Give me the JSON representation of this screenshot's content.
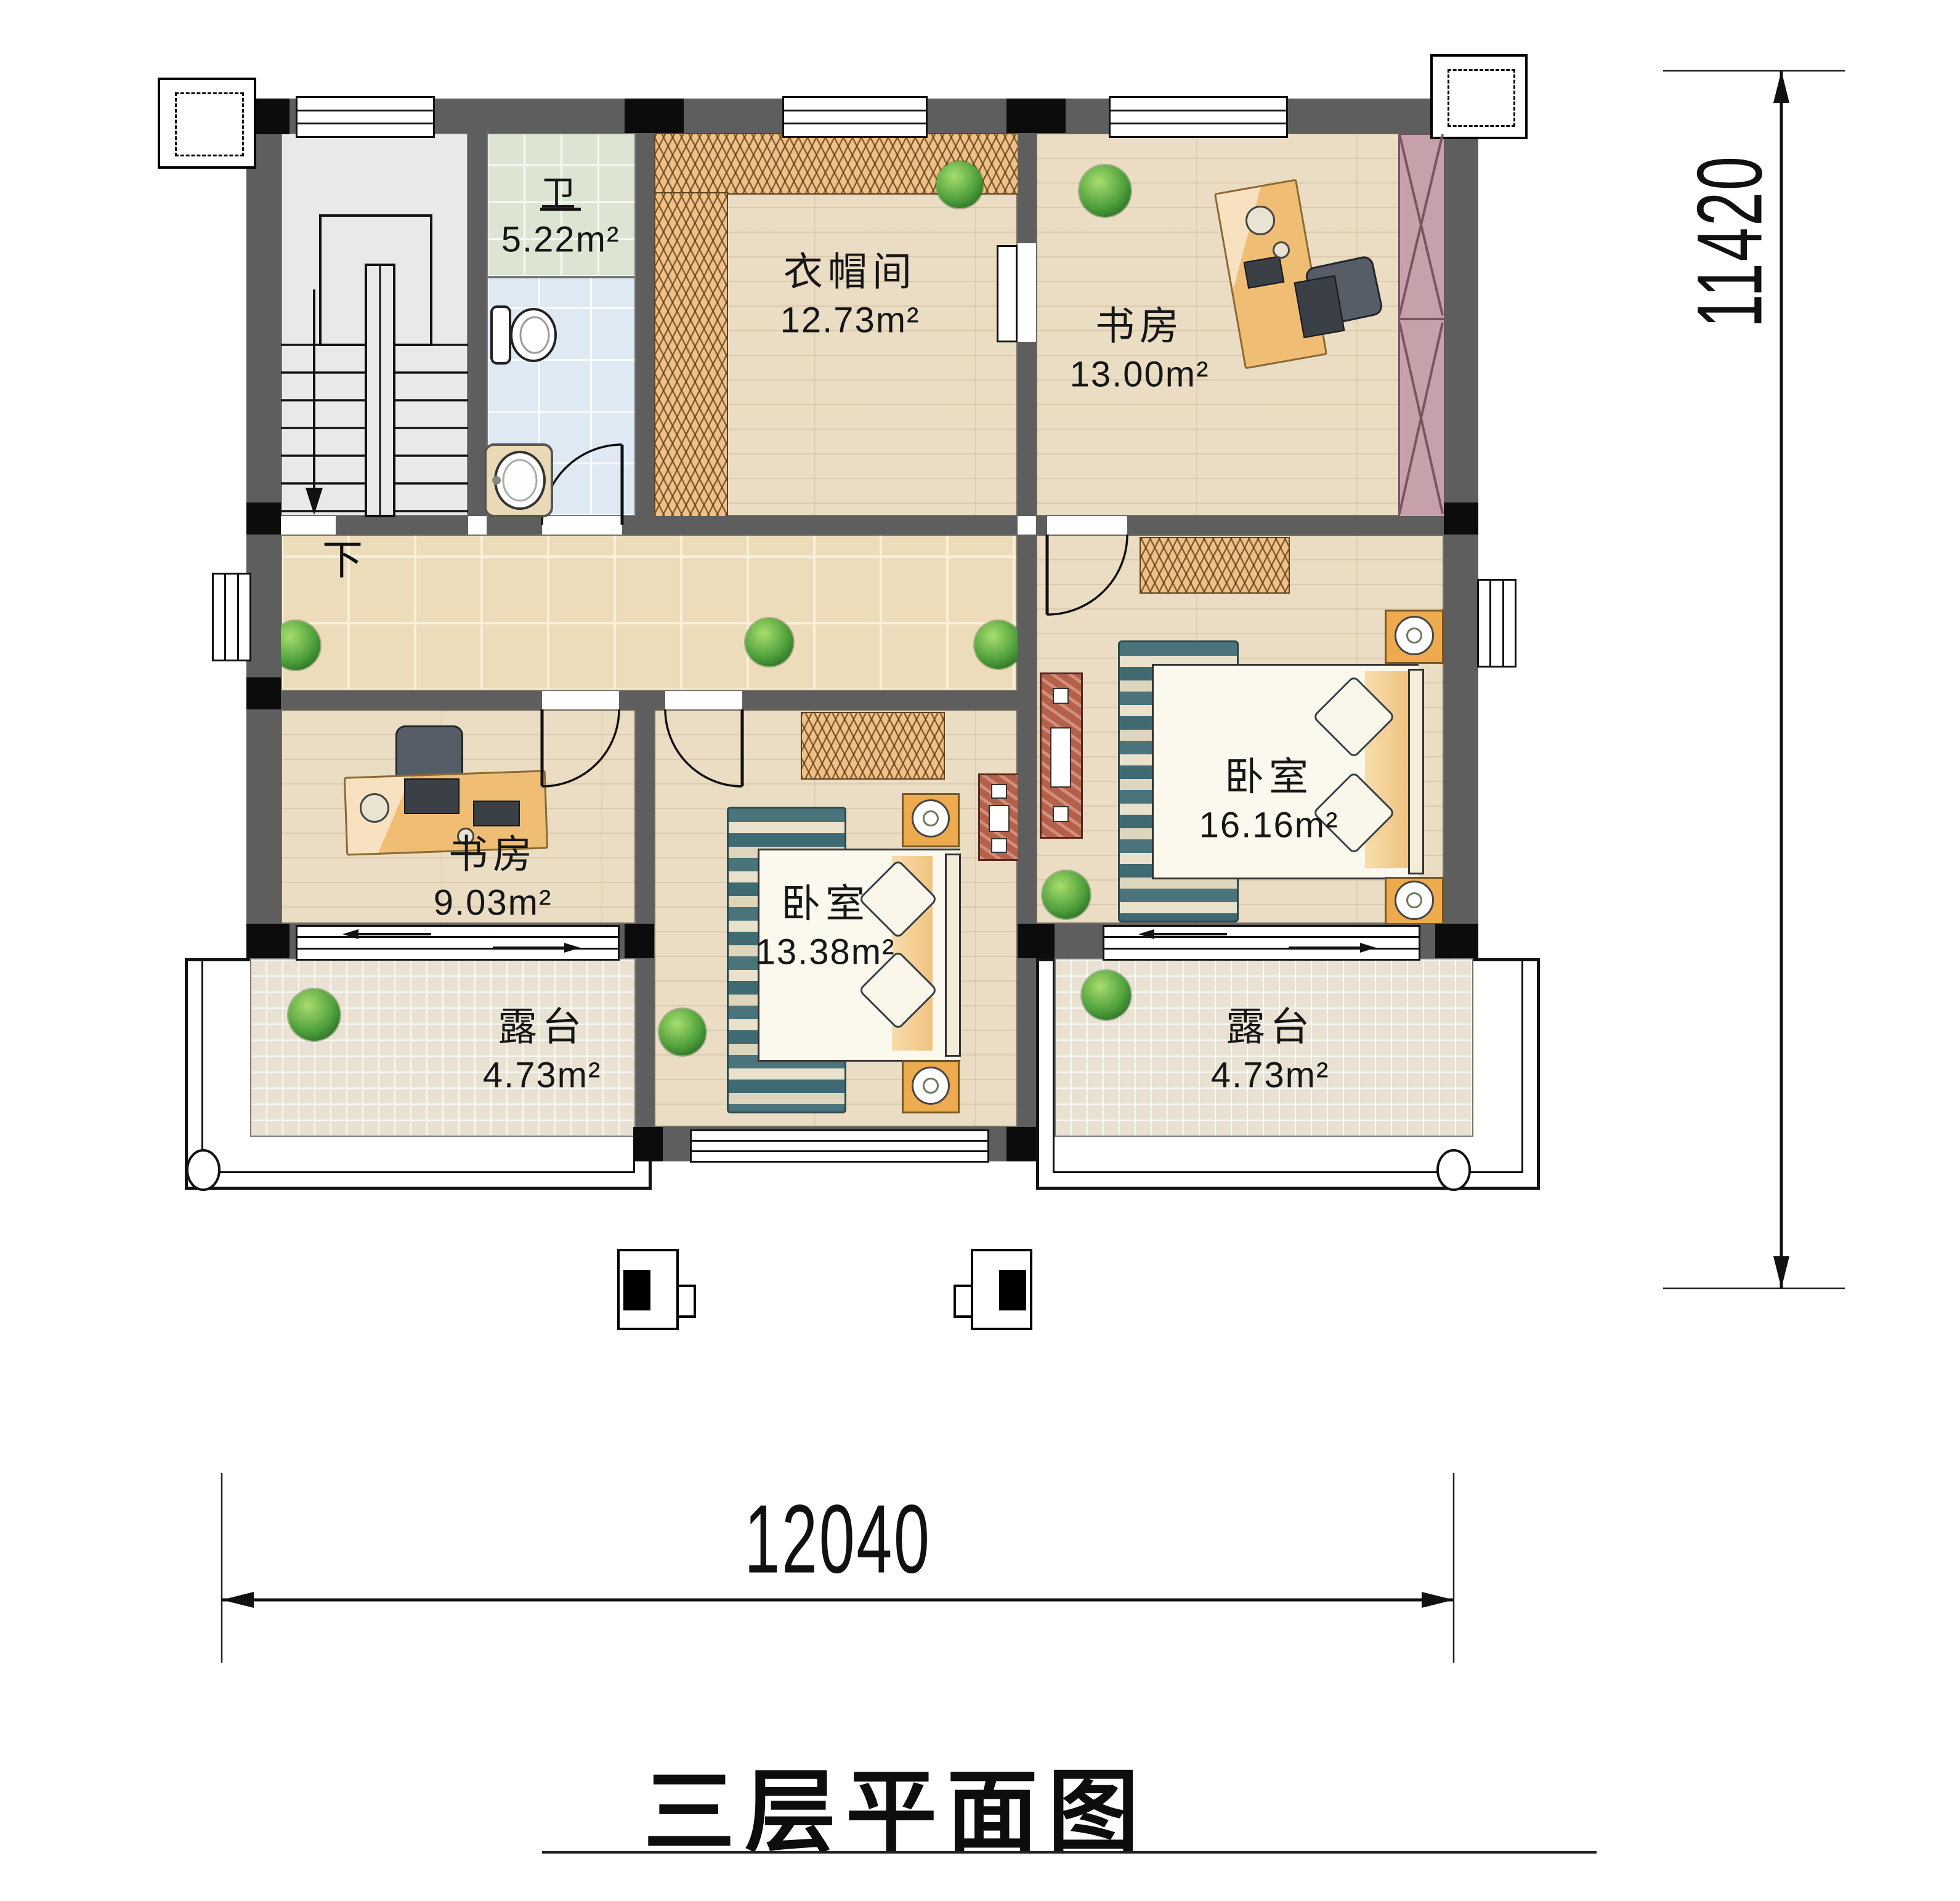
{
  "title": {
    "text": "三层平面图"
  },
  "dimensions": {
    "width": "12040",
    "height": "11420"
  },
  "stair": {
    "down_label": "下"
  },
  "rooms": {
    "bathroom": {
      "name": "卫",
      "area": "5.22m²"
    },
    "cloakroom": {
      "name": "衣帽间",
      "area": "12.73m²"
    },
    "study_top": {
      "name": "书房",
      "area": "13.00m²"
    },
    "bedroom_right": {
      "name": "卧室",
      "area": "16.16m²"
    },
    "study_left": {
      "name": "书房",
      "area": "9.03m²"
    },
    "bedroom_middle": {
      "name": "卧室",
      "area": "13.38m²"
    },
    "terrace_left": {
      "name": "露台",
      "area": "4.73m²"
    },
    "terrace_right": {
      "name": "露台",
      "area": "4.73m²"
    }
  },
  "colors": {
    "wall": "#5e5e5e",
    "wall_column": "#0c0c0c",
    "wood_floor": "#eaddc4",
    "hall_tile": "#ecdcba",
    "terrace_tile": "#e9e2d3",
    "bath_tile_green": "#dce4d2",
    "bath_tile_blue": "#dfe9f3",
    "wardrobe_hatch": "#efc188",
    "wardrobe_pink": "#c6a0aa",
    "rug_teal": "#4a737b",
    "nightstand_orange": "#edaa4e",
    "dresser_red": "#b4604b",
    "plant_green": "#4fa03c"
  }
}
